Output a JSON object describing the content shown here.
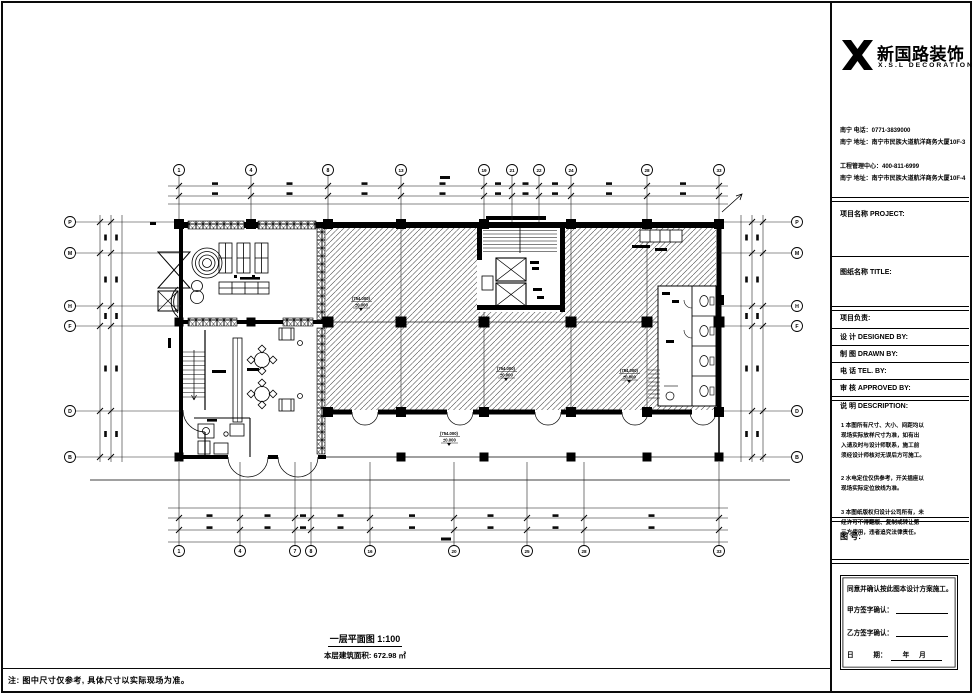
{
  "sheet": {
    "bottom_note": "注: 图中尺寸仅参考, 具体尺寸以实际现场为准。",
    "caption": {
      "title": "一层平面图 1:100",
      "area": "本层建筑面积: 672.98 ㎡"
    }
  },
  "plan": {
    "grid": {
      "top_labels": [
        "1",
        "4",
        "8",
        "13",
        "19",
        "21",
        "22",
        "24",
        "28",
        "33"
      ],
      "bottom_labels": [
        "1",
        "4",
        "7",
        "8",
        "16",
        "20",
        "25",
        "28",
        "33"
      ],
      "left_labels": [
        "P",
        "M",
        "H",
        "F",
        "D",
        "B"
      ],
      "right_labels": [
        "P",
        "M",
        "H",
        "F",
        "D",
        "B"
      ]
    },
    "level_marks": [
      {
        "elev": "(754.000)",
        "rel": "±0.000"
      },
      {
        "elev": "(754.000)",
        "rel": "±0.000"
      },
      {
        "elev": "(754.000)",
        "rel": "±0.000"
      },
      {
        "elev": "(754.000)",
        "rel": "±0.000"
      }
    ]
  },
  "titleblock": {
    "brand": {
      "cn": "新国路装饰",
      "en": "X.S.L DECORATION"
    },
    "contact": [
      "南宁 电话：0771-3839000",
      "南宁 地址：南宁市民族大道航洋商务大厦10F-3",
      "工程管理中心：400-811-6999",
      "南宁 地址：南宁市民族大道航洋商务大厦10F-4"
    ],
    "fields": {
      "project": "项目名称 PROJECT:",
      "title": "图纸名称 TITLE:",
      "lead": "项目负责:",
      "designed": "设 计 DESIGNED BY:",
      "drawn": "制 图 DRAWN BY:",
      "tel": "电 话 TEL. BY:",
      "approved": "审 核 APPROVED BY:",
      "description": "说 明 DESCRIPTION:",
      "drawing_no": "图 号:"
    },
    "notes": [
      "1 本图所有尺寸、大小、间距均以\n现场实际放样尺寸为准，如有出\n入请及时与设计师联系，施工前\n须经设计师核对无误后方可施工。",
      "2 水电定位仅供参考，开关插座以\n现场实际定位放线为准。",
      "3 本图纸版权归设计公司所有，未\n经许可不得翻版、复制或转让第\n三方使用，违者追究法律责任。"
    ],
    "signature": {
      "confirm": "同意并确认按此图本设计方案施工。",
      "party_a": "甲方签字确认：",
      "party_b": "乙方签字确认：",
      "date": {
        "label": "日　　　期：",
        "year": "年",
        "month": "月"
      }
    }
  }
}
